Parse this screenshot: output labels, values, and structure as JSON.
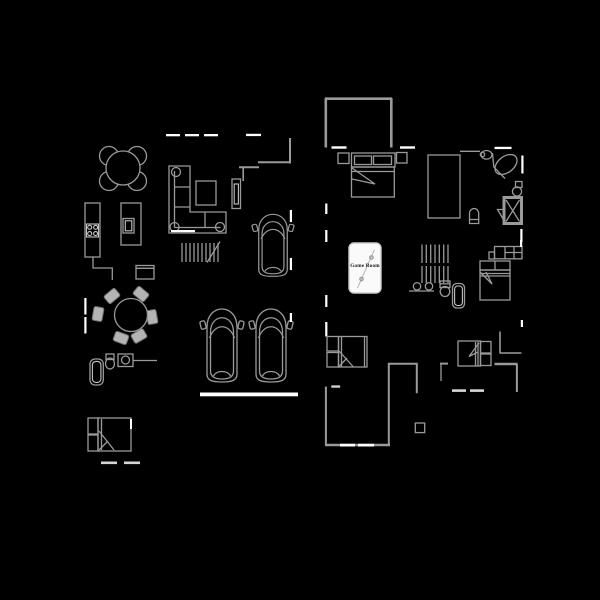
{
  "canvas": {
    "width": 600,
    "height": 600,
    "background": "#000000"
  },
  "palette": {
    "wall": "#9a9a9a",
    "furniture_light": "#c4c4c4",
    "chair_fill": "#b4b4b4",
    "chair_stroke": "#6f6f6f",
    "bright": "#ffffff",
    "window_dim": "#d6d6d6",
    "pool_table_fill": "#fafafa",
    "pool_table_border": "#cccccc",
    "label_text": "#151515"
  },
  "labels": {
    "game_room": "Game Room"
  },
  "symbols": [
    "breakfast-table",
    "kitchen-counter",
    "cooktop-icon",
    "kitchen-island",
    "sink-icon",
    "refrigerator",
    "sectional-sofa",
    "coffee-table",
    "media-console",
    "living-stairs",
    "car",
    "garage-car-left",
    "garage-car-right",
    "garage-door",
    "dining-table",
    "dining-chair",
    "powder-toilet-icon",
    "powder-sink-icon",
    "powder-tub-icon",
    "guest-bed",
    "master-bedroom-walls",
    "master-bed",
    "nightstand",
    "walk-in-closet",
    "corner-tub-icon",
    "vanity-sink-icon",
    "toilet-icon",
    "shower-icon",
    "water-heater-icon",
    "bench-seat",
    "pool-table",
    "main-stairs",
    "double-vanity",
    "hall-tub-icon",
    "bonus-bed-left",
    "bonus-bed-right",
    "upper-bed",
    "patio-walls",
    "window-dash"
  ]
}
